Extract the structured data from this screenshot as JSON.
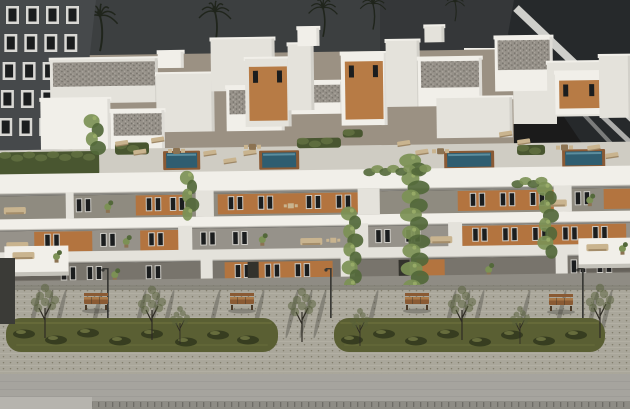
{
  "palette": {
    "sky": "#3c3f40",
    "sky_right": "#2f3233",
    "palm": "#20251c",
    "dark_bldg": "#46494b",
    "dark_bldg_frame": "#d9d8d4",
    "window_dark": "#1b1d1e",
    "glass_bldg": "#26292b",
    "glass_band": "#cfcfcb",
    "court_wall": "#9b9183",
    "terrace_floor": "#cfccc3",
    "white_hi": "#f1efe9",
    "white_mid": "#e4e2db",
    "white_low": "#d6d3cb",
    "slab_shadow": "#b9b6ae",
    "recess_a": "#8f8b80",
    "recess_b": "#96928a",
    "recess_g": "#78746c",
    "walkway": "#8f8c84",
    "orange": "#b3743f",
    "orange_ph": "#b77b45",
    "win_frame": "#cfcdc7",
    "door": "#33322c",
    "hedge_dark": "#495630",
    "hedge_light": "#70804a",
    "vine_main": "#7c9155",
    "vine_dark": "#53683a",
    "vine_light": "#9db06b",
    "pool_water": "#2f5d70",
    "pool_shine": "#6ea2b2",
    "pool_deck": "#8a5a35",
    "furn_beige": "#c9b48f",
    "furn_dark": "#8c7352",
    "paving": "#aaa79b",
    "paving_dot": "#827e6d",
    "paving_line": "#b3b0a4",
    "grass": "#5a5f33",
    "grass_light": "#71763f",
    "bush_dark": "#333a1e",
    "bush_light": "#7c814a",
    "road": "#a6a49e",
    "road_line": "#9a9892",
    "curb": "#8e8c85",
    "curb_dark": "#6e6c66",
    "patch": "#b6b4ae",
    "bench_wood": "#8a5a33",
    "bench_top": "#aa7a49",
    "bench_dark": "#4a3a28",
    "lamp": "#393935",
    "shadow": "#2e2d28",
    "trunk": "#2e2b24",
    "leaf": "#55603a",
    "gravel_base": "#969189",
    "gravel_dark": "#6e6a63",
    "gravel_light": "#b5b0a7",
    "dark_edge": "#3b3b37"
  },
  "sky": {
    "palms": [
      [
        100,
        16,
        1.1
      ],
      [
        215,
        12,
        1.0
      ],
      [
        323,
        8,
        0.9
      ],
      [
        373,
        4,
        0.8
      ],
      [
        455,
        2,
        0.6
      ],
      [
        548,
        4,
        0.95
      ],
      [
        592,
        0,
        0.8
      ],
      [
        36,
        0,
        0.65
      ]
    ]
  },
  "neighbors": {
    "left": {
      "windows": {
        "cols": [
          6,
          26,
          46,
          66
        ],
        "rows": [
          6,
          34,
          62,
          90,
          118
        ],
        "w": 13,
        "h": 18
      }
    }
  },
  "building": {
    "roof_volumes": [
      [
        52,
        56,
        108,
        44,
        "g",
        "w"
      ],
      [
        42,
        96,
        70,
        50,
        "",
        "w"
      ],
      [
        158,
        72,
        58,
        58,
        "",
        "w"
      ],
      [
        112,
        108,
        54,
        40,
        "g",
        "w"
      ],
      [
        213,
        38,
        64,
        52,
        "",
        "w"
      ],
      [
        228,
        86,
        58,
        44,
        "g",
        "w"
      ],
      [
        247,
        58,
        46,
        68,
        "",
        "o"
      ],
      [
        293,
        82,
        52,
        32,
        "g",
        "w"
      ],
      [
        290,
        44,
        26,
        66,
        "",
        "w"
      ],
      [
        343,
        54,
        46,
        72,
        "",
        "o"
      ],
      [
        388,
        42,
        34,
        66,
        "",
        "w"
      ],
      [
        420,
        60,
        64,
        48,
        "g",
        "w"
      ],
      [
        438,
        100,
        76,
        40,
        "",
        "w"
      ],
      [
        497,
        40,
        58,
        54,
        "g",
        "w"
      ],
      [
        549,
        66,
        56,
        54,
        "",
        "w"
      ],
      [
        557,
        76,
        48,
        42,
        "",
        "o"
      ],
      [
        601,
        60,
        32,
        62,
        "",
        "w"
      ],
      [
        300,
        28,
        22,
        18,
        "",
        "w"
      ],
      [
        427,
        28,
        20,
        16,
        "",
        "w"
      ],
      [
        160,
        50,
        26,
        16,
        "",
        "w"
      ]
    ],
    "terrace": {
      "hedges": [
        [
          0,
          148,
          100,
          24
        ],
        [
          116,
          140,
          34,
          12
        ],
        [
          298,
          138,
          44,
          10
        ],
        [
          344,
          130,
          20,
          8
        ],
        [
          518,
          148,
          28,
          10
        ]
      ],
      "loungers": [
        [
          116,
          139
        ],
        [
          134,
          148
        ],
        [
          152,
          136
        ],
        [
          204,
          150
        ],
        [
          224,
          158
        ],
        [
          244,
          150
        ],
        [
          398,
          143
        ],
        [
          416,
          152
        ],
        [
          500,
          135
        ],
        [
          518,
          143
        ],
        [
          588,
          150
        ],
        [
          606,
          158
        ]
      ],
      "tables": [
        [
          174,
          146
        ],
        [
          250,
          143
        ],
        [
          438,
          150
        ],
        [
          562,
          148
        ]
      ],
      "pools": [
        [
          167,
          151,
          31,
          15
        ],
        [
          263,
          152,
          34,
          15
        ],
        [
          448,
          155,
          44,
          14
        ],
        [
          566,
          155,
          37,
          14
        ]
      ]
    },
    "floor_a": {
      "top": 190,
      "orange": [
        [
          136,
          50
        ],
        [
          218,
          142
        ],
        [
          458,
          98
        ],
        [
          604,
          30
        ]
      ],
      "piers": [
        [
          66,
          8
        ],
        [
          196,
          18
        ],
        [
          358,
          22
        ],
        [
          554,
          18
        ]
      ],
      "winpairs": [
        76,
        146,
        170,
        228,
        258,
        306,
        336,
        470,
        500,
        530,
        575
      ],
      "furn": [
        4,
        545
      ],
      "plants": [
        108,
        590
      ],
      "tables": [
        288
      ],
      "doors": []
    },
    "floor_b": {
      "top": 225,
      "orange": [
        [
          34,
          58
        ],
        [
          140,
          40
        ],
        [
          462,
          164
        ]
      ],
      "piers": [
        [
          178,
          14
        ],
        [
          352,
          16
        ],
        [
          448,
          14
        ]
      ],
      "winpairs": [
        44,
        100,
        148,
        200,
        232,
        375,
        405,
        472,
        502,
        532,
        562,
        592
      ],
      "furn": [
        6,
        300,
        430
      ],
      "plants": [
        126,
        262
      ],
      "tables": [
        330
      ],
      "doors": []
    },
    "ground": {
      "top": 258,
      "orange": [
        [
          224,
          108
        ],
        [
          416,
          28
        ]
      ],
      "piers": [
        [
          200,
          12
        ],
        [
          340,
          14
        ],
        [
          555,
          12
        ]
      ],
      "winpairs": [
        60,
        86,
        145,
        234,
        264,
        294,
        570,
        596
      ],
      "furn": [],
      "plants": [
        114,
        488
      ],
      "tables": [],
      "doors": [
        247,
        398
      ]
    },
    "protruding": [
      [
        4,
        242,
        64,
        30
      ],
      [
        578,
        242,
        56,
        30
      ]
    ],
    "vines": [
      [
        415,
        162,
        292,
        9
      ],
      [
        352,
        214,
        290,
        6
      ],
      [
        190,
        176,
        214,
        5
      ],
      [
        548,
        192,
        260,
        6
      ],
      [
        96,
        118,
        148,
        6
      ]
    ],
    "parapet_greens": [
      [
        370,
        168,
        62,
        14
      ],
      [
        518,
        182,
        30,
        12
      ]
    ]
  },
  "street": {
    "benches": [
      [
        84,
        297
      ],
      [
        230,
        297
      ],
      [
        405,
        297
      ],
      [
        549,
        298
      ]
    ],
    "lamps": [
      107,
      330,
      582
    ],
    "trees": [
      [
        45,
        338,
        1
      ],
      [
        152,
        340,
        1
      ],
      [
        302,
        342,
        1
      ],
      [
        462,
        340,
        1
      ],
      [
        600,
        338,
        1
      ],
      [
        180,
        344,
        0.7
      ],
      [
        360,
        346,
        0.7
      ],
      [
        520,
        344,
        0.7
      ]
    ],
    "grass_islands": [
      [
        6,
        318,
        272,
        34
      ],
      [
        334,
        318,
        271,
        34
      ]
    ],
    "bushes": [
      [
        24,
        334
      ],
      [
        56,
        340
      ],
      [
        88,
        333
      ],
      [
        120,
        341
      ],
      [
        152,
        334
      ],
      [
        186,
        342
      ],
      [
        218,
        335
      ],
      [
        248,
        340
      ],
      [
        352,
        340
      ],
      [
        384,
        334
      ],
      [
        416,
        341
      ],
      [
        448,
        334
      ],
      [
        480,
        342
      ],
      [
        512,
        335
      ],
      [
        544,
        341
      ],
      [
        576,
        335
      ]
    ],
    "shadow_wisps": [
      34,
      47,
      60,
      96,
      140,
      154,
      168,
      214,
      258,
      292,
      306,
      320,
      372,
      450,
      464,
      478,
      524,
      560,
      592,
      606
    ]
  }
}
